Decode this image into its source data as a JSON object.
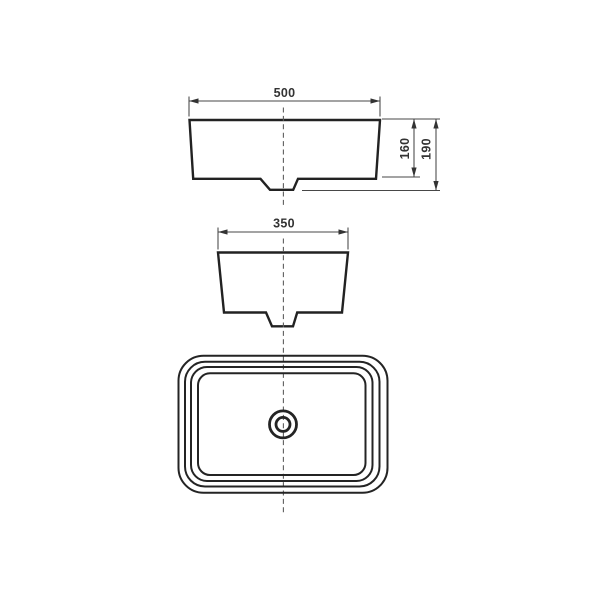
{
  "drawing": {
    "kind": "technical-dimension-drawing",
    "colors": {
      "background": "#ffffff",
      "outline": "#222222",
      "dimension_lines": "#474747",
      "centerline": "#5f5f5f",
      "text": "#333333"
    },
    "dimensions": {
      "front_width": "500",
      "side_width": "350",
      "basin_height": "160",
      "overall_height": "190"
    }
  }
}
